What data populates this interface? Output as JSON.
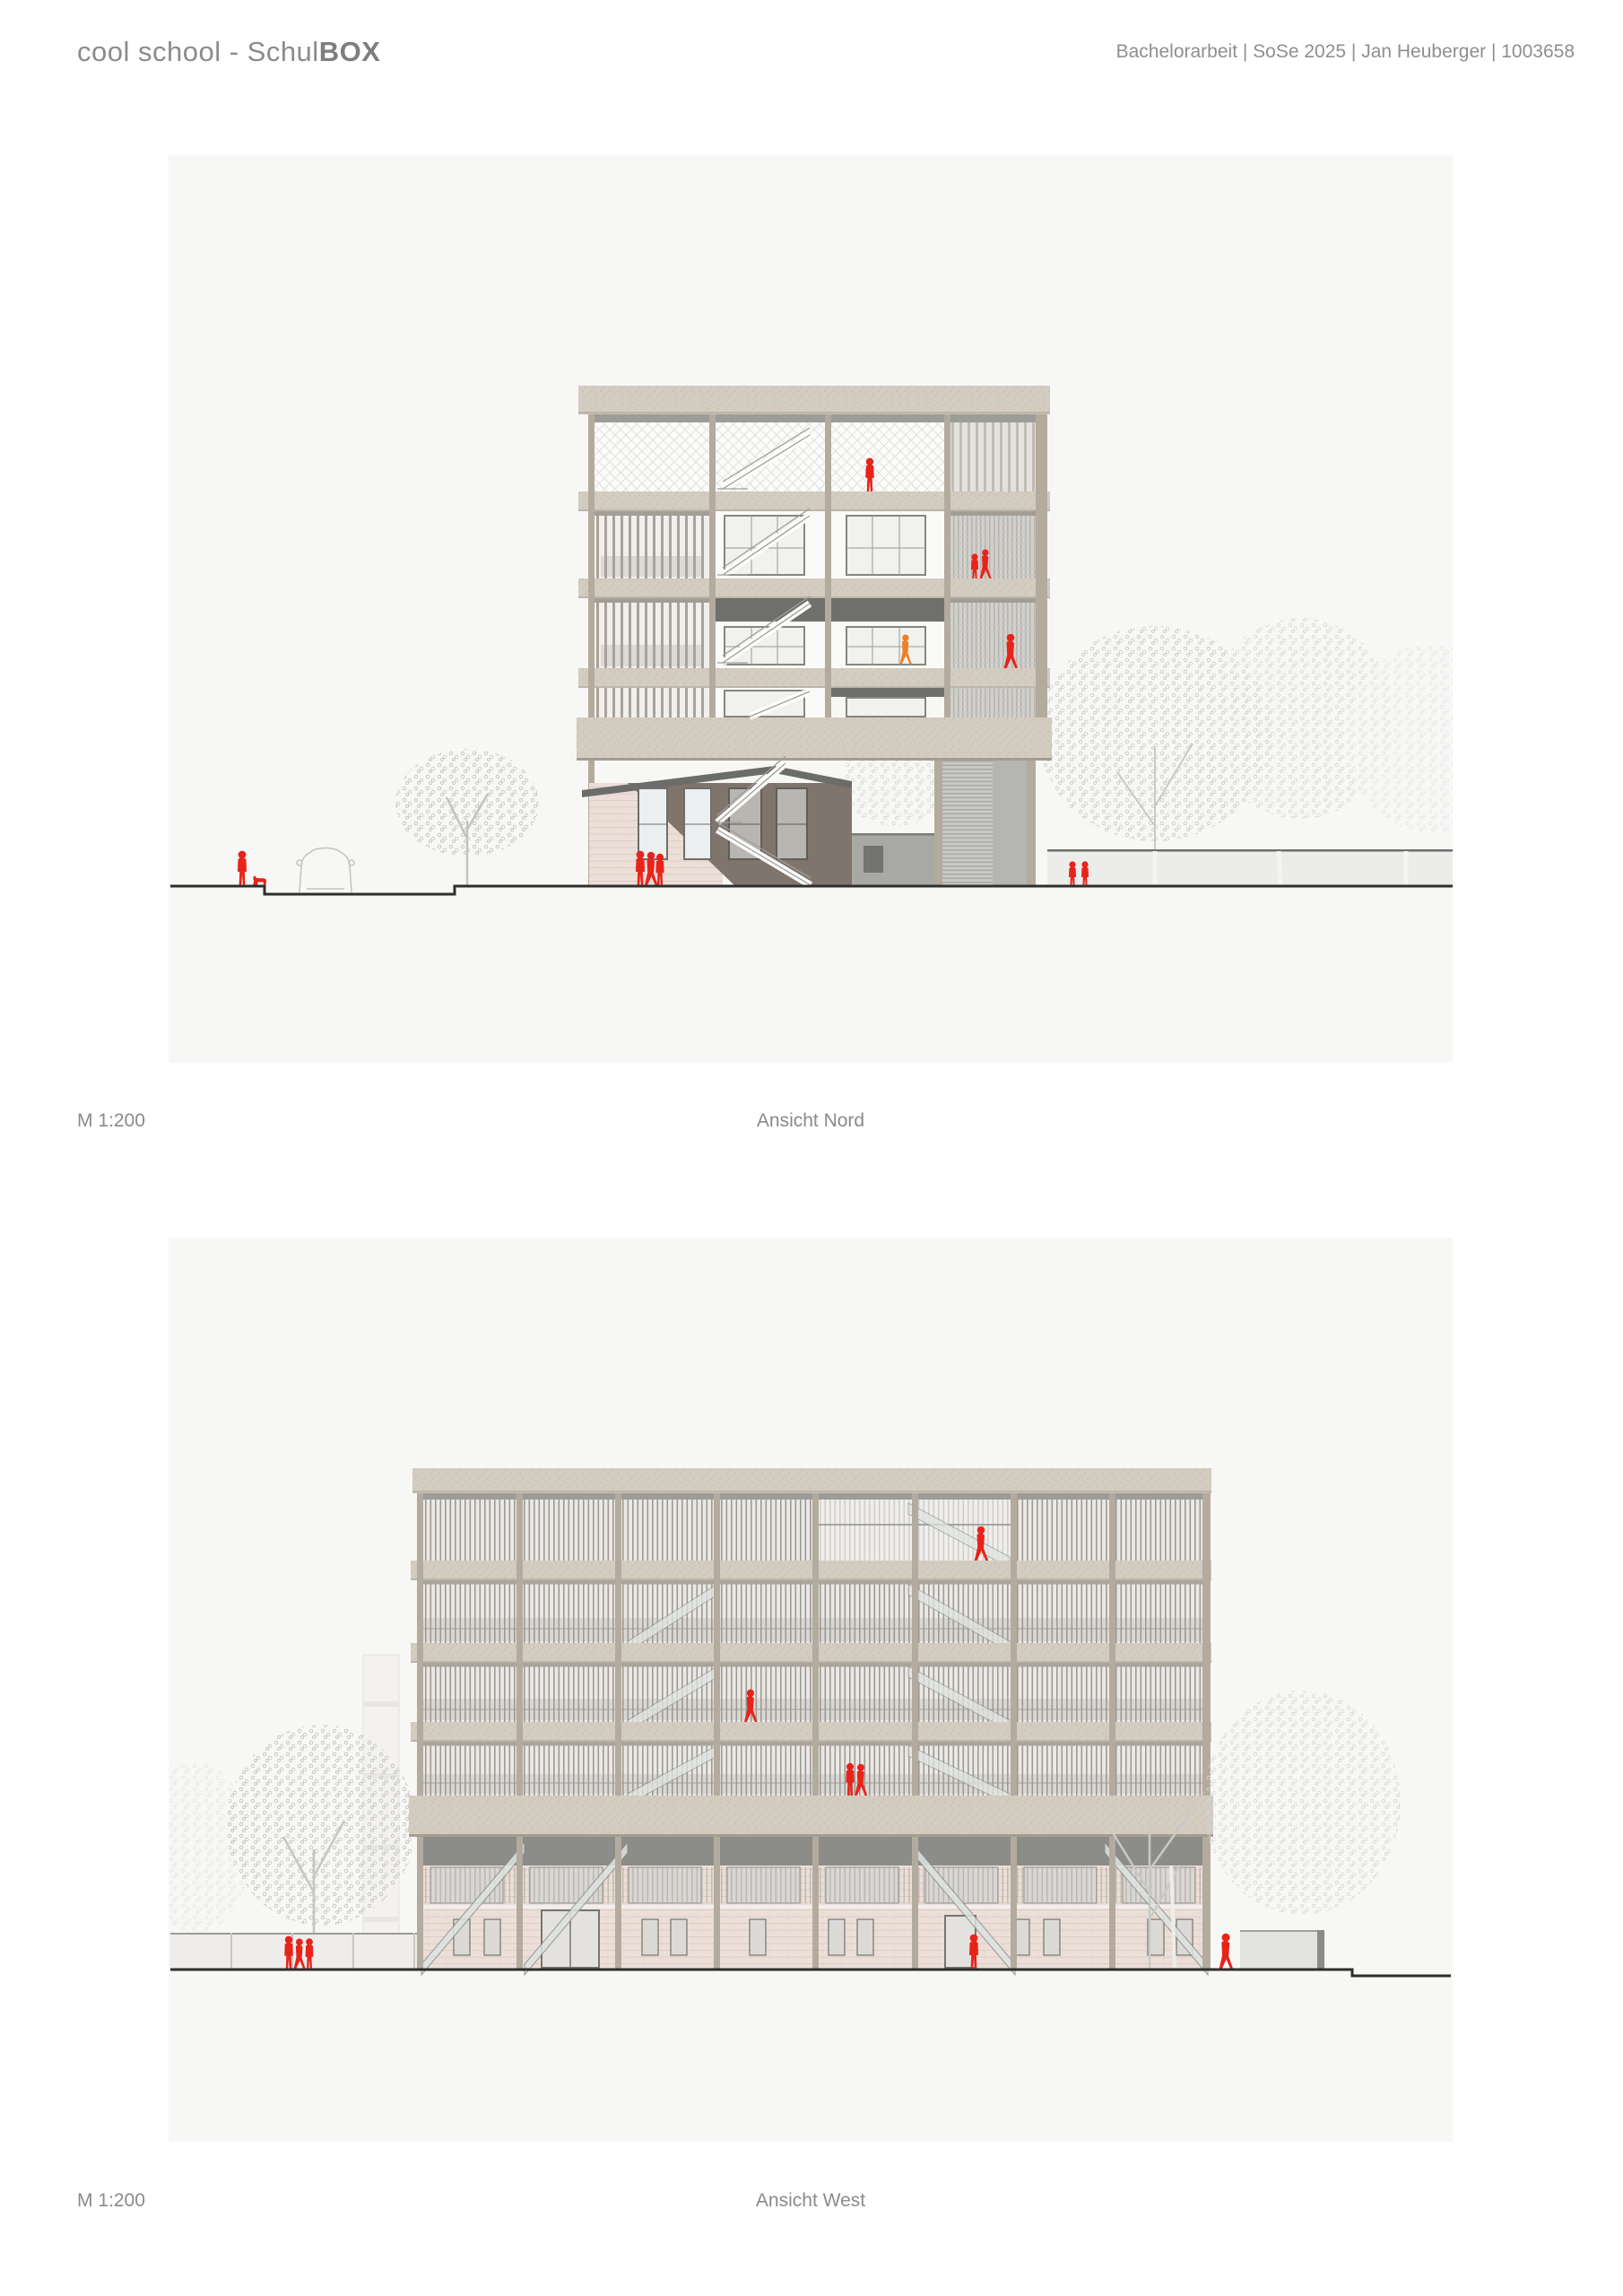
{
  "header": {
    "title": {
      "regular": "cool school - Schul",
      "bold": "BOX"
    },
    "meta": "Bachelorarbeit | SoSe 2025 | Jan Heuberger | 1003658"
  },
  "drawings": {
    "nord": {
      "scale": "M 1:200",
      "caption": "Ansicht Nord"
    },
    "west": {
      "scale": "M 1:200",
      "caption": "Ansicht West"
    }
  },
  "palette": {
    "page_bg": "#ffffff",
    "panel_bg": "#f7f7f6",
    "text_gray": "#8b8b8b",
    "concrete": "#d3ccc0",
    "concrete_edge": "#b9b1a3",
    "column_beige": "#b3ab9e",
    "shadow_dark": "#6f6f6c",
    "strip_gray": "#9c9c99",
    "brick_pink": "#ecdfd8",
    "annex_shadow": "#80756d",
    "roof_dark": "#6c6c6a",
    "core_gray": "#c9c9c6",
    "wall_gray": "#ececea",
    "glass_green": "#dde3e0",
    "figure_red": "#e8231a",
    "figure_orange": "#ef7f1f",
    "tree_gray": "#c9c9c7",
    "ground_line": "#2e2e2c"
  }
}
